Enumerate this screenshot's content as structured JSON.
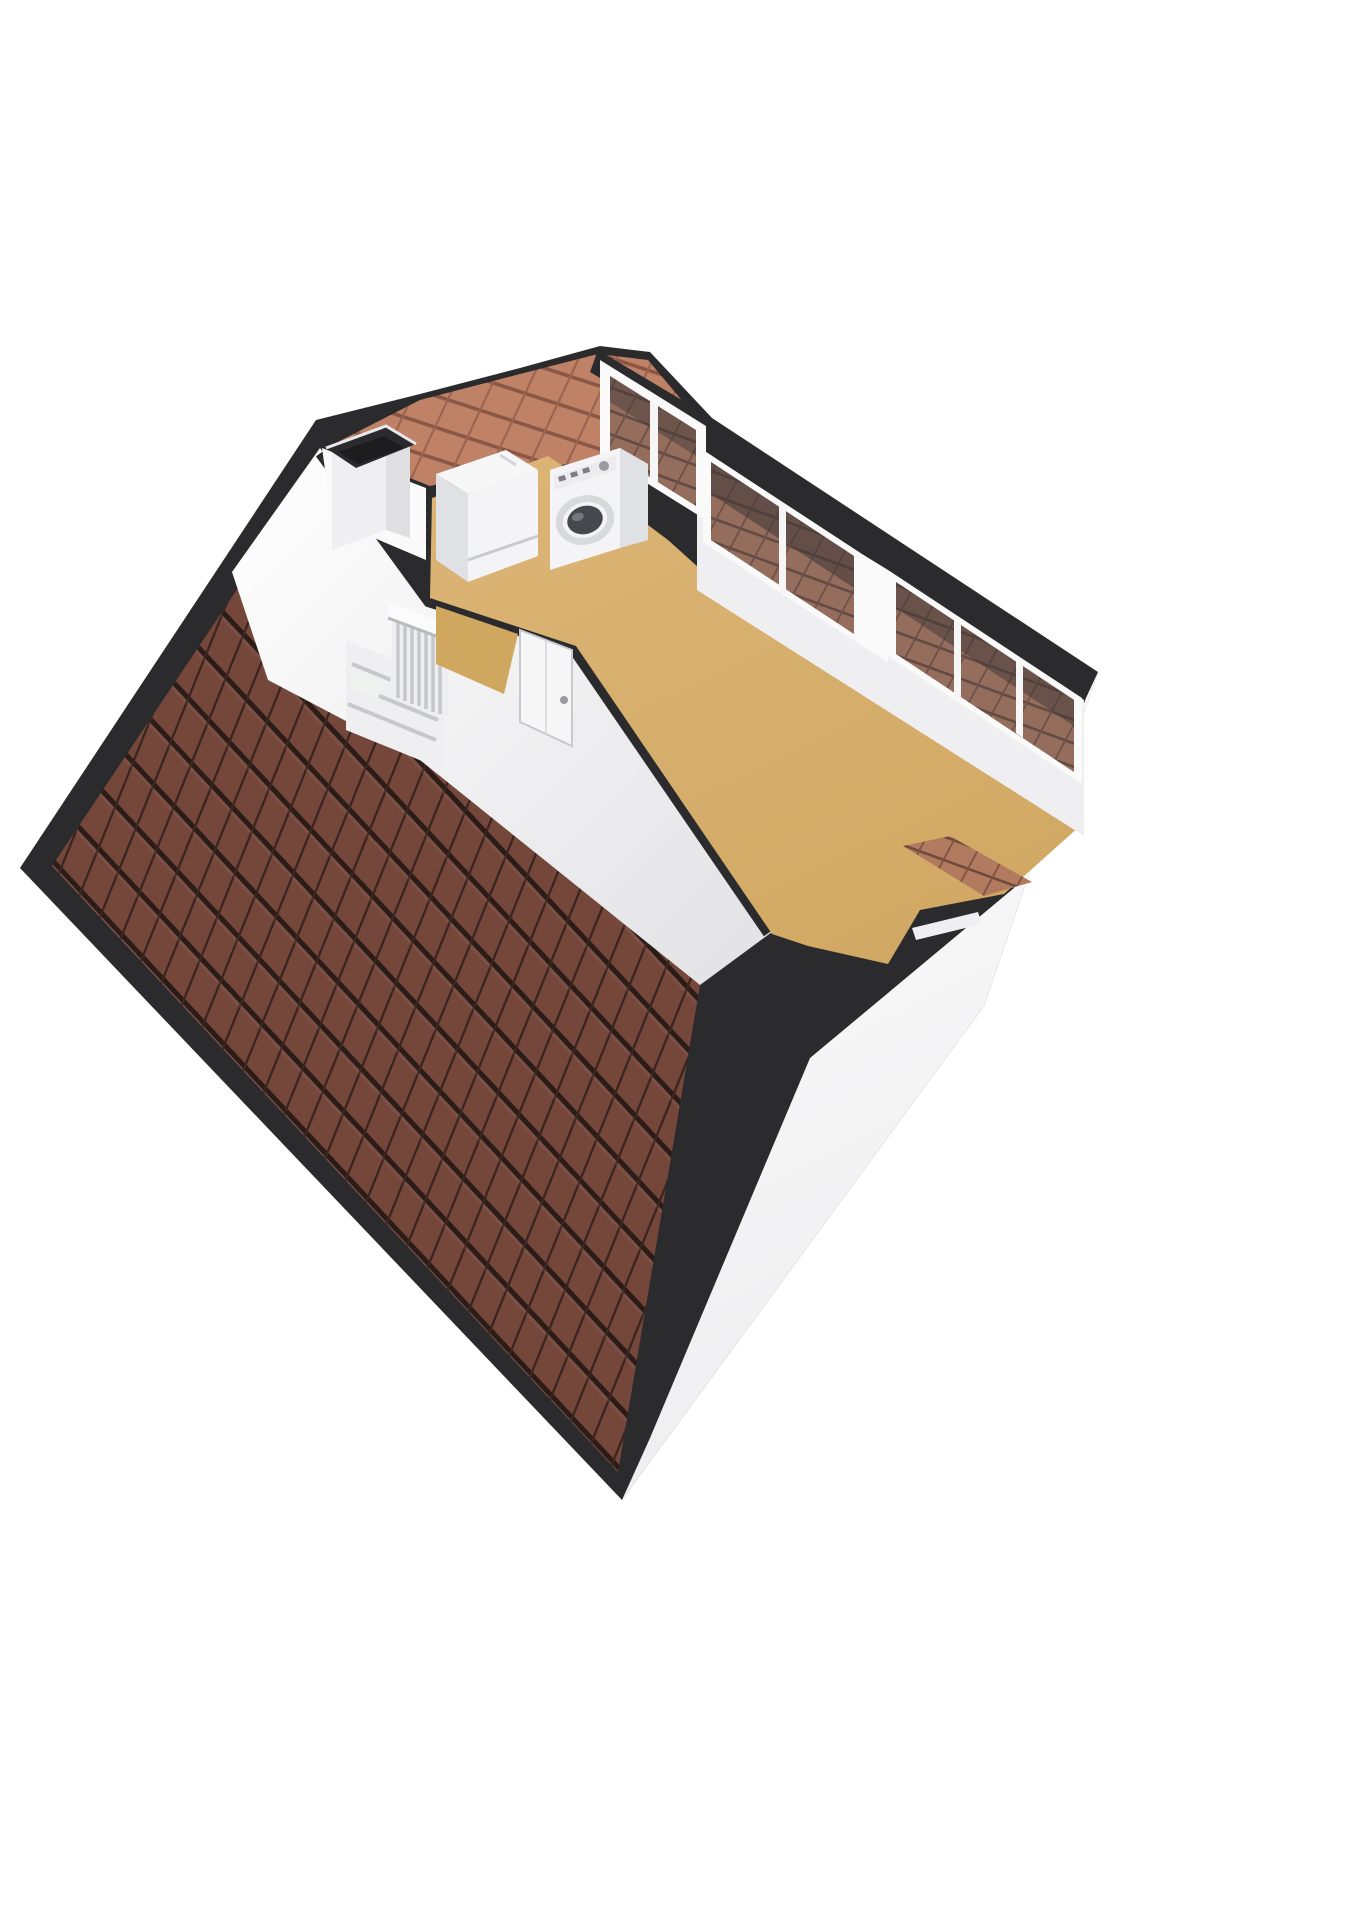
{
  "scene": {
    "kind": "isometric-3d-floorplan-render",
    "floor": "attic",
    "objects": [
      {
        "id": "roof-main",
        "label": "pitched-roof-tiled"
      },
      {
        "id": "roof-small",
        "label": "rear-roof-slope-tiled"
      },
      {
        "id": "chimney",
        "label": "chimney-shaft"
      },
      {
        "id": "boiler",
        "label": "wall-boiler-unit"
      },
      {
        "id": "washing-machine",
        "label": "washing-machine-front-loader"
      },
      {
        "id": "staircase",
        "label": "staircase-down"
      },
      {
        "id": "stair-railing",
        "label": "stair-balustrade"
      },
      {
        "id": "interior-door",
        "label": "interior-door-closed"
      },
      {
        "id": "gable-window",
        "label": "gable-window-two-pane"
      },
      {
        "id": "window-band-upper",
        "label": "dormer-window-band-two-pane"
      },
      {
        "id": "window-band-lower",
        "label": "dormer-window-band-three-pane"
      },
      {
        "id": "dormer",
        "label": "dormer-notch"
      },
      {
        "id": "dormer-roof-patch",
        "label": "dormer-side-roof-tiles"
      },
      {
        "id": "floor-main",
        "label": "attic-room-floor"
      },
      {
        "id": "floor-landing",
        "label": "stair-landing-floor"
      },
      {
        "id": "gable-end-face",
        "label": "gable-end-exterior-wall"
      }
    ]
  },
  "colors": {
    "background": "#ffffff",
    "edge": "#2b2b2d",
    "edge-deep": "#1d1d1f",
    "roof-tile": "#75473a",
    "roof-gap": "#2c1c17",
    "roof-rib": "#3b251f",
    "roof-small": "#bf8267",
    "roof-small-line": "#8a5745",
    "glass-tile": "#b27a5f",
    "glass-line": "#6e4a3c",
    "glass-tint": "rgba(72,76,86,0.28)",
    "wall-bright": "#fafafa",
    "wall-light": "#efeff1",
    "wall-mid": "#dfdfe2",
    "wall-shade": "#cfcfd3",
    "floor": "#d8b172",
    "floor-warm": "#d0a75f",
    "appliance": "#f4f4f6",
    "appliance-shade": "#e0e1e4",
    "washer-door": "#45484e",
    "void": "#eef1ee"
  }
}
